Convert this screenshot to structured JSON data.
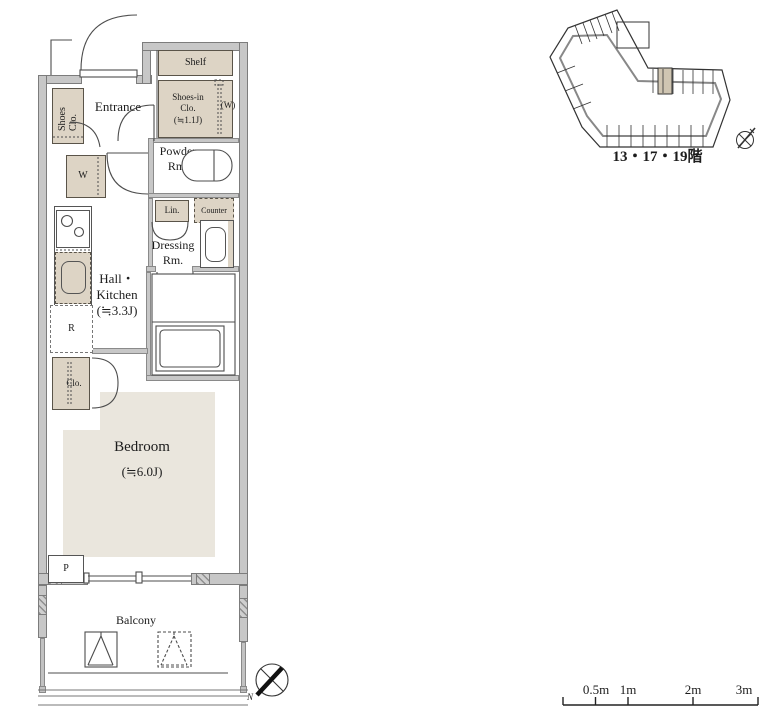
{
  "colors": {
    "wall_fill": "#c7c7c7",
    "wall_edge": "#7c7c7c",
    "fixture_beige": "#ddd4c5",
    "rug_beige": "#eae6dd",
    "line": "#4d4d4d"
  },
  "floorplan": {
    "labels": {
      "entrance": "Entrance",
      "shoes_clo": "Shoes Clo.",
      "shelf": "Shelf",
      "shoes_in_clo": "Shoes-in\nClo.\n(≒1.1J)",
      "w_paren": "(W)",
      "powder_rm": "Powder\nRm.",
      "washer": "W",
      "linen": "Lin.",
      "counter": "Counter",
      "dressing_rm": "Dressing\nRm.",
      "hall_kitchen": "Hall・\nKitchen\n(≒3.3J)",
      "bath": "Bath",
      "bath_size": "(1116)",
      "fridge": "R",
      "closet": "Clo.",
      "bedroom": "Bedroom",
      "bedroom_size": "(≒6.0J)",
      "pipe_space": "P",
      "balcony": "Balcony",
      "north": "N"
    }
  },
  "keyplan": {
    "caption": "13・17・19階"
  },
  "scalebar": {
    "labels": [
      "0.5m",
      "1m",
      "2m",
      "3m"
    ]
  }
}
